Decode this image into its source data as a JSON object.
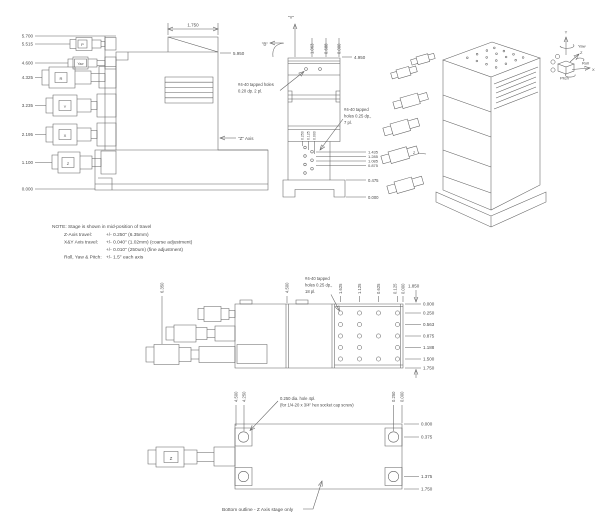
{
  "front": {
    "left_dims": [
      "5.700",
      "5.515",
      "4.600",
      "4.325",
      "3.235",
      "2.195",
      "1.100",
      "0.000"
    ],
    "mic_labels": {
      "p": "P",
      "yaw": "Yaw",
      "r": "R",
      "y": "Y",
      "x": "X",
      "z": "Z"
    },
    "top_width_dim": "1.750",
    "height_dim": "5.950",
    "axis_label": "\"Z\" Axis"
  },
  "side": {
    "y_axis_label": "\"Y\"",
    "view_label": "\"B\"",
    "top_dims": [
      "1.063",
      "0.688",
      "0.000"
    ],
    "height_dim": "4.950",
    "tapped_note_top": [
      "#4-40 tapped holes",
      "0.20 dp. 2 pl."
    ],
    "tapped_note_front": [
      "#4-40 tapped",
      "holes 0.25 dp.,",
      "7 pl."
    ],
    "hole_col_dims": [
      "0.250",
      "0.125",
      "0.000"
    ],
    "right_dims": [
      "1.435",
      "1.285",
      "1.085",
      "0.875",
      "0.475",
      "0.000"
    ]
  },
  "iso": {
    "z_mic_label": "Z"
  },
  "axis_indicator": {
    "y": "Y",
    "yaw": "Yaw",
    "z": "Z",
    "roll": "Roll",
    "x": "X",
    "pitch": "Pitch"
  },
  "note": {
    "line1": "NOTE: Stage is shown in mid-position of travel",
    "z_travel_label": "Z-Axis travel:",
    "z_travel_value": "+/- 0.250\" (6.35mm)",
    "xy_travel_label": "X&Y Axis travel:",
    "xy_travel_value": "+/- 0.040\" (1.02mm) (coarse adjustment)",
    "xy_travel_value2": "+/- 0.010\" (250um) (fine adjustment)",
    "rot_travel_label": "Roll, Yaw & Pitch:",
    "rot_travel_value": "+/- 1.5° each axis"
  },
  "plan": {
    "overall_dim": "6.350",
    "body_dim": "4.500",
    "tapped_note": [
      "#4-40 tapped",
      "holes 0.25 dp.,",
      "18 pl."
    ],
    "col_dims": [
      "1.625",
      "1.125",
      "0.625",
      "0.125",
      "0.000"
    ],
    "width_dim": "1.850",
    "row_dims": [
      "0.000",
      "0.250",
      "0.563",
      "0.875",
      "1.188",
      "1.500",
      "1.750"
    ]
  },
  "bottom": {
    "mic_label": "Z",
    "col_dims_left": [
      "4.500",
      "4.250"
    ],
    "hole_note": [
      "0.250 dia. hole 4pl.",
      "(for 1/4-20 x 3/4\" hex socket cap screw)"
    ],
    "col_dims_right": [
      "0.250",
      "0.000"
    ],
    "row_dims": [
      "0.000",
      "0.375",
      "1.375",
      "1.750"
    ],
    "caption": "Bottom outline - Z Axis stage only"
  }
}
